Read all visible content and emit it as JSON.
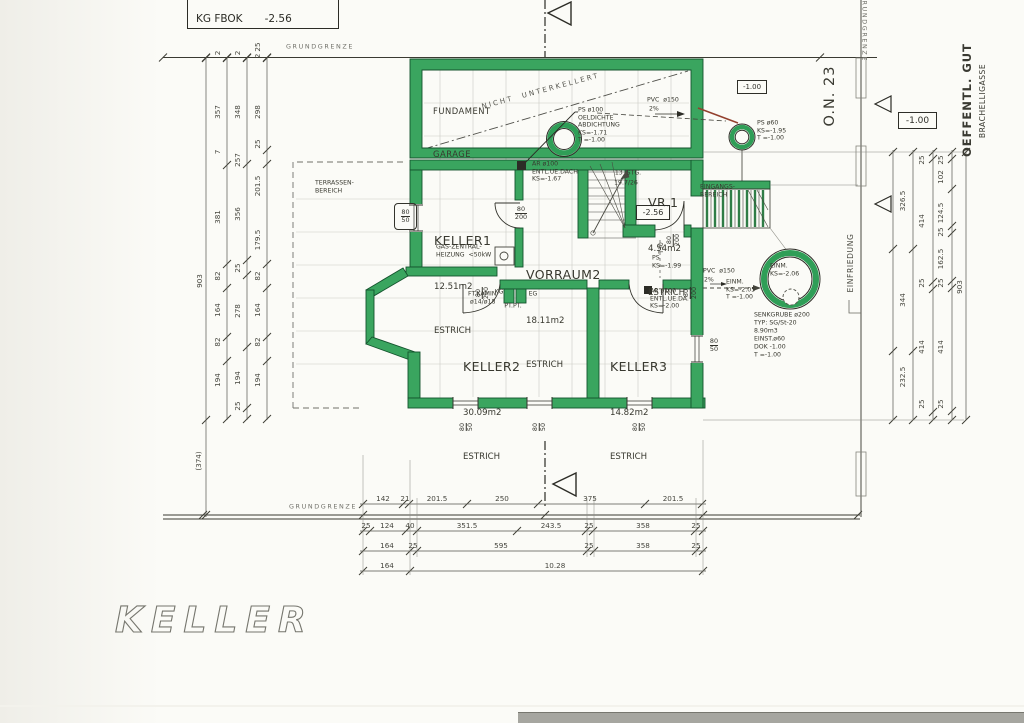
{
  "title_box": {
    "label": "KG FBOK",
    "value": "-2.56"
  },
  "sheet_title": "KELLER",
  "boundaries": {
    "grundgrenze_top": "GRUNDGRENZE",
    "grundgrenze_bottom": "GRUNDGRENZE",
    "grundgrenze_right": "GRUNDGRENZE",
    "einfriedung": "EINFRIEDUNG"
  },
  "site": {
    "public_land": "OEFFENTL. GUT",
    "street_name": "BRACHELLIGASSE",
    "house_number": "O.N. 23",
    "level_plan": "-1.00",
    "level_street": "-1.00"
  },
  "rooms": {
    "garage": {
      "line1": "FUNDAMENT",
      "line2": "GARAGE",
      "note": "NICHT  UNTERKELLERT"
    },
    "keller1": {
      "name": "KELLER1",
      "area": "12.51m2",
      "floor": "ESTRICH"
    },
    "vorraum2": {
      "name": "VORRAUM2",
      "area": "18.11m2",
      "floor": "ESTRICH"
    },
    "vr1": {
      "name": "VR.1",
      "area": "4.54m2",
      "floor": "ESTRICH",
      "level": "-2.56"
    },
    "keller2": {
      "name": "KELLER2",
      "area": "30.09m2",
      "floor": "ESTRICH"
    },
    "keller3": {
      "name": "KELLER3",
      "area": "14.82m2",
      "floor": "ESTRICH"
    }
  },
  "annotations": {
    "heating1": "GAS-ZENTRAL-",
    "heating2": "HEIZUNG  <50kW",
    "stairs1": "13  STG.",
    "stairs2": "19.7/26",
    "terrace1": "TERRASSEN-",
    "terrace2": "BEREICH",
    "entrance1": "EINGANGS-",
    "entrance2": "BEREICH",
    "ps100_1": "PS ø100",
    "ps100_2": "OELDICHTE",
    "ps100_3": "ABDICHTUNG",
    "ps100_4": "KS=-1.71",
    "ps100_5": "T =-1.00",
    "pvc_top1": "PVC  ø150",
    "pvc_top2": "2%",
    "ps60_1": "PS ø60",
    "ps60_2": "KS=-1.95",
    "ps60_3": "T =-1.00",
    "ar_dach1": "AR ø100",
    "ar_dach2": "ENTL.UE.DACH",
    "ar_dach3": "KS=-1.67",
    "ar_da1": "AR ø100",
    "ar_da2": "ENTL.UE.DA.",
    "ar_da3": "KS=-2.00",
    "ps_vr1": "PS",
    "ps_vr2": "KS=-1.99",
    "pvc_mid1": "PVC  ø150",
    "pvc_mid2": "2%",
    "einm_mid1": "EINM.",
    "einm_mid2": "KS=-2.05",
    "einm_mid3": "T =-1.00",
    "einm_gr1": "EINM.",
    "einm_gr2": "KS=-2.06",
    "senk1": "SENKGRUBE ø200",
    "senk2": "TYP: SG/St-20",
    "senk3": "8.90m3",
    "senk4": "EINST.ø60",
    "senk5": "DOK -1.00",
    "senk6": "T =-1.00",
    "kamin1": "FT.KAMIN",
    "kamin2": "ø14/ø18",
    "kg": "KG",
    "eg": "EG",
    "ptpt": "PT.PT."
  },
  "openings": {
    "door_w": "80",
    "door_h": "200",
    "window_w": "80",
    "window_h": "50",
    "t30": "T30"
  },
  "dims": {
    "left_col1": [
      "2",
      "357",
      "7",
      "381",
      "82",
      "164",
      "82",
      "194"
    ],
    "left_col2": [
      "2",
      "348",
      "257",
      "356",
      "25",
      "278",
      "194",
      "25"
    ],
    "left_col3": [
      "25",
      "2",
      "298",
      "25",
      "201.5",
      "179.5",
      "82",
      "164",
      "82",
      "194"
    ],
    "left_overall": "903",
    "left_extra": "(374)",
    "right_col1": [
      "326.5",
      "344",
      "232.5"
    ],
    "right_col2": [
      "25",
      "414",
      "25",
      "414",
      "25"
    ],
    "right_col3": [
      "25",
      "102",
      "124.5",
      "25",
      "162.5",
      "25",
      "414",
      "25"
    ],
    "right_overall": "903",
    "bottom_row1": [
      "142",
      "21",
      "201.5",
      "250",
      "375",
      "201.5"
    ],
    "bottom_row2": [
      "25",
      "124",
      "40",
      "351.5",
      "243.5",
      "25",
      "358",
      "25"
    ],
    "bottom_row3": [
      "164",
      "25",
      "595",
      "25",
      "358",
      "25"
    ],
    "bottom_row4": [
      "164",
      "10.28"
    ]
  }
}
